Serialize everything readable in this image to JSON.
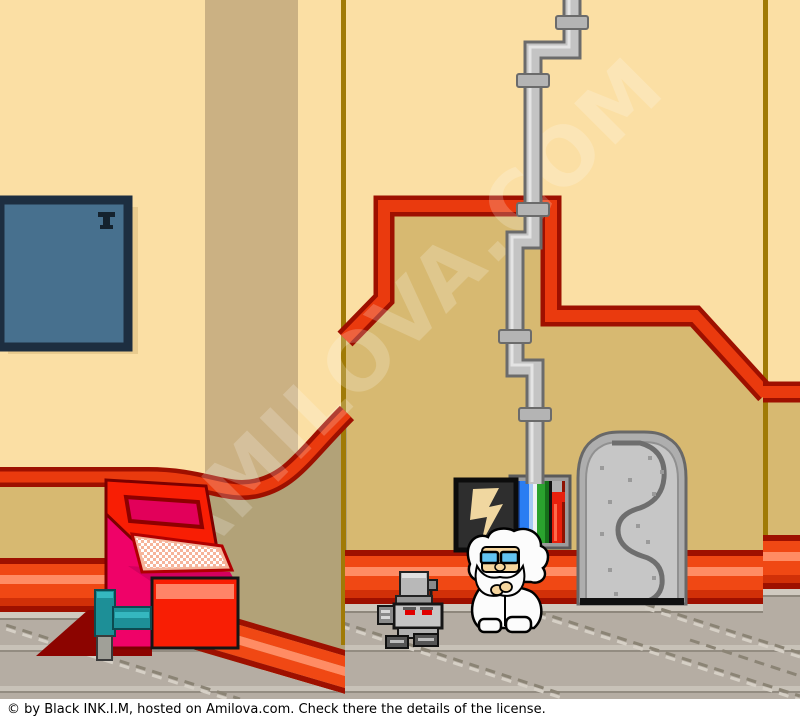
{
  "window": {
    "width": 800,
    "height": 721
  },
  "caption": {
    "text": "© by Black INK.I.M, hosted on Amilova.com. Check there the details of the license."
  },
  "watermark": {
    "text": "AMILOVA.COM"
  },
  "scene": {
    "entities": [
      "blue-wall-panel",
      "wall-corner-pillar",
      "red-wall-trim",
      "gray-wall-pipe",
      "lightning-panel",
      "pipe-cabinet",
      "metal-door",
      "computer-console",
      "teal-lever",
      "service-robot",
      "scientist-character",
      "baseboard",
      "tiled-floor"
    ]
  },
  "palette": {
    "wall_cream": "#fbdfa4",
    "wall_tan": "#d7b971",
    "pillar_band": "#cbb183",
    "pillar_shadow": "#b2a278",
    "corner_line": "#a07a06",
    "trim_red": "#ea3a0e",
    "trim_dark_red": "#9e1000",
    "baseboard_salmon": "#ff8c64",
    "floor_gray": "#b5ada3",
    "floor_line": "#8b8475",
    "door_gray": "#c6c6c6",
    "panel_steel_blue": "#47708e",
    "console_red": "#f81e04",
    "console_pink": "#ef0268",
    "console_screen_magenta": "#e2005a",
    "lever_teal": "#1d8f97",
    "cabinet_blue": "#2a7df2",
    "cabinet_green": "#2aa22e",
    "cabinet_red": "#e8200c",
    "robot_gray": "#c6c6c6",
    "robot_eye_red": "#e00000",
    "glasses_blue": "#62c4f2",
    "skin": "#f6d69e"
  }
}
